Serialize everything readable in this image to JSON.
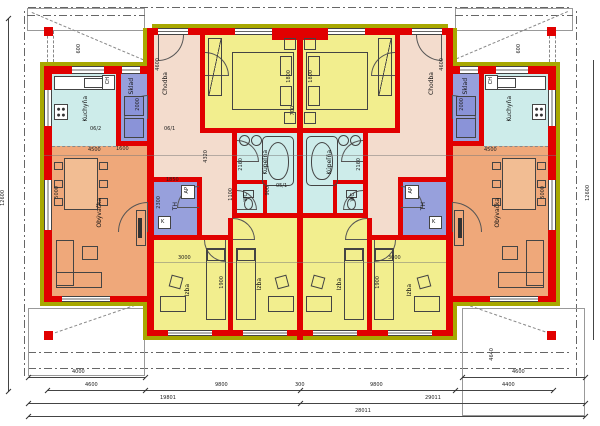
{
  "plan": {
    "rooms": {
      "kitchen": "Kuchyňa",
      "storage": "Sklad",
      "fridge": "CH",
      "hall": "Chodba",
      "bath": "Kúpeľňa",
      "wc": "WC",
      "tech": "TH",
      "appliance": "AP",
      "boiler": "K",
      "living": "Obývačka",
      "room": "Izba"
    },
    "dims": {
      "hall_len": "4600",
      "storage_len": "2000",
      "bath_w": "2160",
      "wc_w": "1100",
      "wc_d": "900",
      "tech_len": "2300",
      "tech_w": "1850",
      "living_len": "5000",
      "living_w": "4500",
      "room_w": "3000",
      "room_len": "1900",
      "bed_w": "1800",
      "wall_gap": "700",
      "post": "600",
      "hall2": "4320",
      "pass": "1600",
      "code_a": "06/1",
      "code_b": "06/2",
      "code_c": "05/1",
      "b1l": "4000",
      "b1r": "4600",
      "b2": [
        "4600",
        "9800",
        "300",
        "9800"
      ],
      "b2r": "4400",
      "b3l": "19801",
      "b3r": "29011",
      "b4": "28011",
      "height_total": "12600",
      "porch_r": "4640"
    },
    "colors": {
      "wall": "#e10000",
      "insulation": "#a8a800",
      "bedroom": "#f2ee8e",
      "wet_room": "#cdecea",
      "storage": "#97a0dc",
      "hall": "#f3dccd",
      "living": "#efa87a"
    }
  }
}
